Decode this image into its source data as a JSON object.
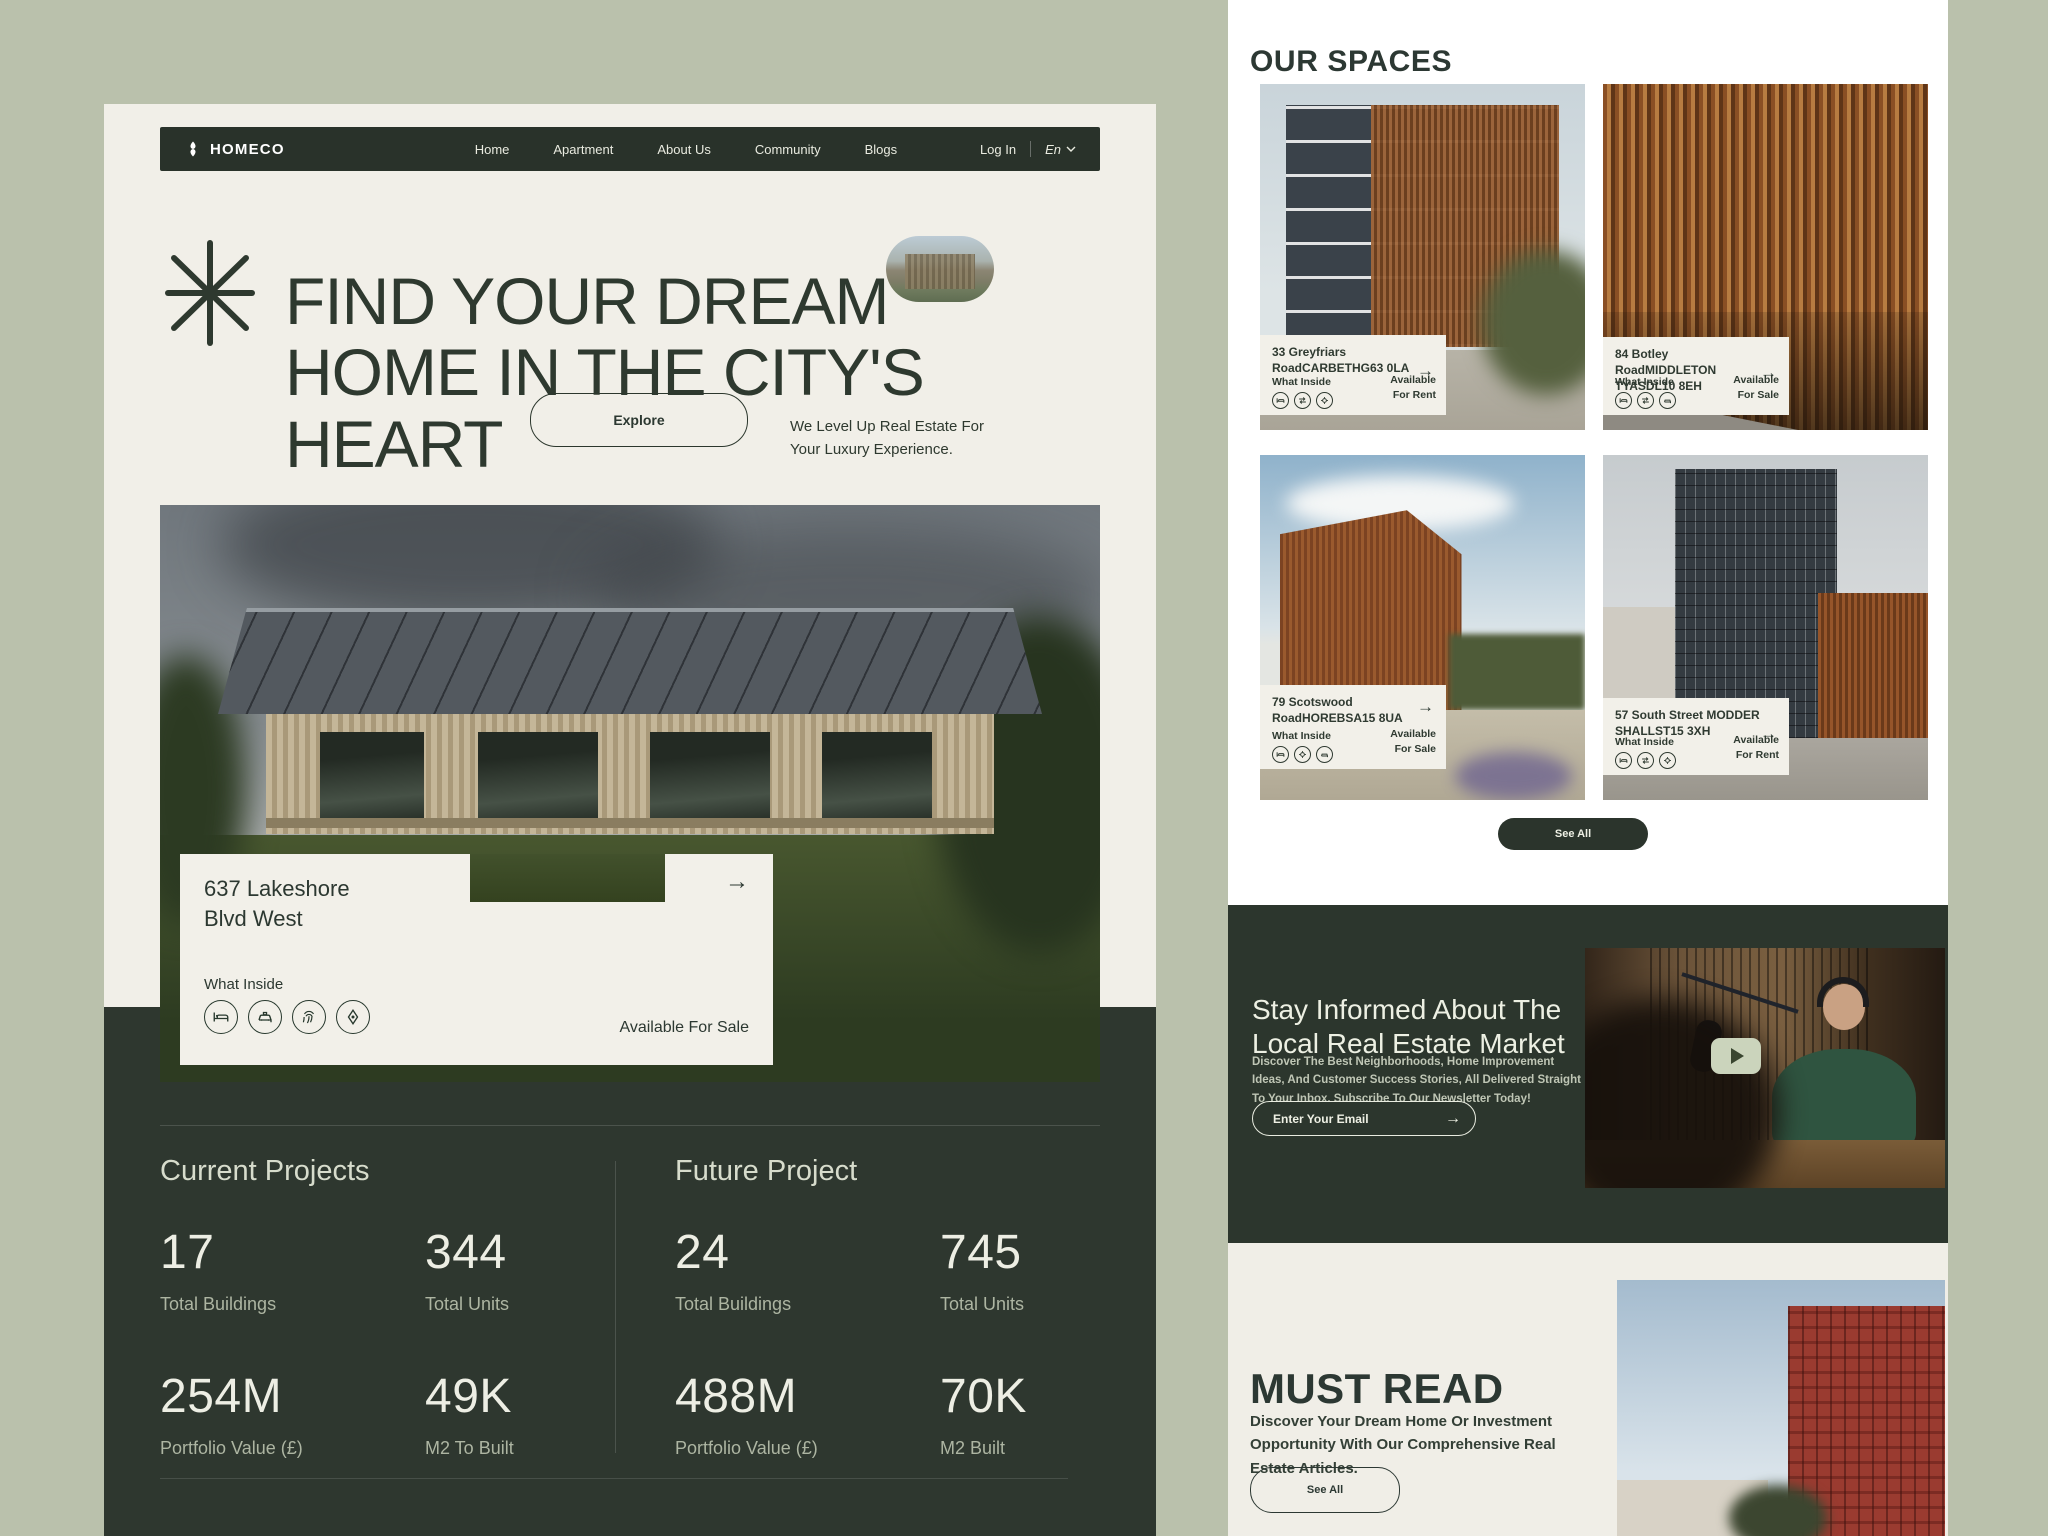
{
  "colors": {
    "sage": "#bac1ac",
    "cream": "#f1efe8",
    "white": "#ffffff",
    "dark": "#2b352c",
    "dark_panel": "#2e372f",
    "text_dark": "#2c3831",
    "text_light": "#edeee3",
    "bronze": "#a0663a"
  },
  "icons": {
    "arrow_right": "→",
    "chevron_down": "⌄",
    "play": "▶",
    "asterisk": "✳"
  },
  "nav": {
    "logo": "HOMECO",
    "items": [
      "Home",
      "Apartment",
      "About Us",
      "Community",
      "Blogs"
    ],
    "login": "Log In",
    "lang": "En"
  },
  "hero": {
    "title": "FIND YOUR DREAM\nHOME IN THE CITY'S\nHEART",
    "explore": "Explore",
    "tagline": "We Level Up Real Estate For\nYour Luxury Experience."
  },
  "listing": {
    "address": "637 Lakeshore\nBlvd West",
    "what_inside": "What Inside",
    "availability": "Available For Sale"
  },
  "stats": {
    "current": {
      "title": "Current Projects",
      "items": [
        {
          "value": "17",
          "label": "Total Buildings"
        },
        {
          "value": "344",
          "label": "Total Units"
        },
        {
          "value": "254M",
          "label": "Portfolio Value (£)"
        },
        {
          "value": "49K",
          "label": "M2 To Built"
        }
      ]
    },
    "future": {
      "title": "Future Project",
      "items": [
        {
          "value": "24",
          "label": "Total Buildings"
        },
        {
          "value": "745",
          "label": "Total Units"
        },
        {
          "value": "488M",
          "label": "Portfolio Value (£)"
        },
        {
          "value": "70K",
          "label": "M2 Built"
        }
      ]
    }
  },
  "spaces": {
    "title": "OUR SPACES",
    "see_all": "See All",
    "cards": [
      {
        "address": "33 Greyfriars\nRoadCARBETHG63 0LA",
        "what_inside": "What Inside",
        "availability": "Available\nFor Rent"
      },
      {
        "address": "84 Botley\nRoadMIDDLETON\nTYASDL10 8EH",
        "what_inside": "What Inside",
        "availability": "Available\nFor Sale"
      },
      {
        "address": "79 Scotswood\nRoadHOREBSA15 8UA",
        "what_inside": "What Inside",
        "availability": "Available\nFor Sale"
      },
      {
        "address": "57 South Street MODDER\nSHALLST15 3XH",
        "what_inside": "What Inside",
        "availability": "Available\nFor Rent"
      }
    ]
  },
  "newsletter": {
    "title": "Stay Informed About The\nLocal Real Estate Market",
    "body": "Discover The Best Neighborhoods, Home Improvement Ideas, And Customer Success Stories, All Delivered Straight To Your Inbox. Subscribe To Our Newsletter Today!",
    "email_placeholder": "Enter Your Email"
  },
  "must_read": {
    "title": "MUST READ",
    "body": "Discover Your Dream Home Or Investment Opportunity With Our Comprehensive Real Estate Articles.",
    "see_all": "See All"
  }
}
